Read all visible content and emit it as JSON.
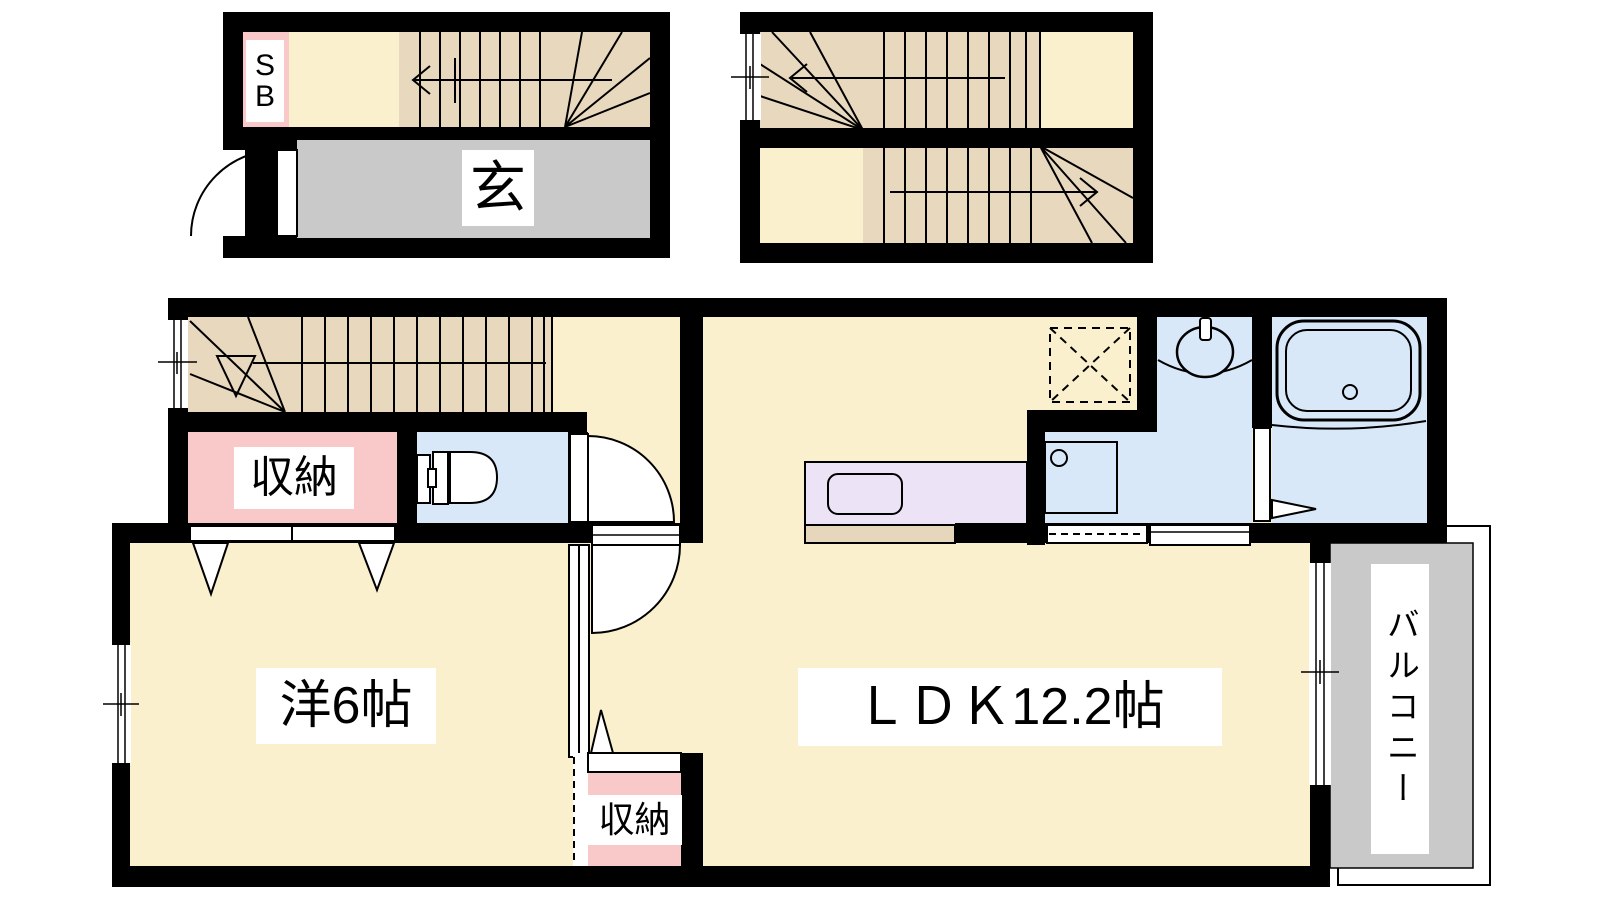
{
  "floor_plan": {
    "entrance_block": {
      "shoe_box_label_lines": [
        "S",
        "B"
      ],
      "entrance_label": "玄"
    },
    "main_block": {
      "storage_upper_label": "収納",
      "western_room_label": "洋6帖",
      "ldk_label": "ＬＤＫ12.2帖",
      "storage_lower_label": "収納",
      "balcony_label": "バルコニー"
    }
  },
  "colors": {
    "floor_cream": "#FAF0CE",
    "stair_tan": "#E8D8BE",
    "entrance_gray": "#C9C9C9",
    "closet_pink": "#F9C8C8",
    "water_blue": "#D9E8F9",
    "kitchen_lavender": "#EDE3F7",
    "counter_tan": "#E6D6BC",
    "wall_black": "#000000"
  }
}
